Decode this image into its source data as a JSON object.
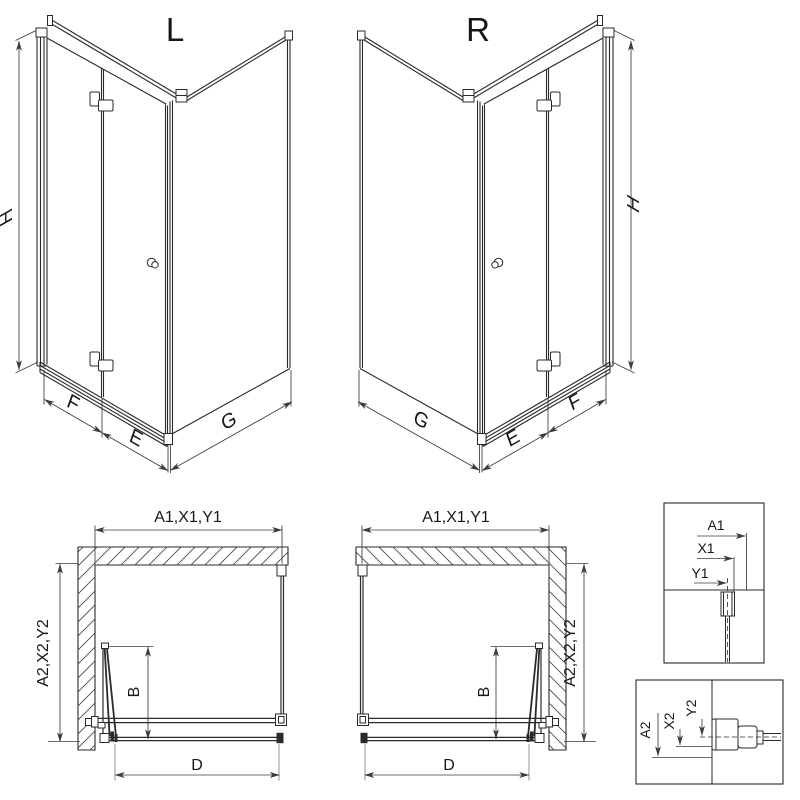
{
  "drawing": {
    "background": "#ffffff",
    "line_color": "#2a2a2a",
    "dim_color": "#3c3c3c",
    "views": {
      "iso_left": {
        "label": "L",
        "height_dim": "H",
        "door_fold_dim": "F",
        "door_fixed_dim": "E",
        "side_panel_dim": "G"
      },
      "iso_right": {
        "label": "R",
        "height_dim": "H",
        "door_fold_dim": "F",
        "door_fixed_dim": "E",
        "side_panel_dim": "G"
      },
      "plan_left": {
        "width_dim": "A1,X1,Y1",
        "depth_dim": "A2,X2,Y2",
        "door_dim": "B",
        "opening_dim": "D"
      },
      "plan_right": {
        "width_dim": "A1,X1,Y1",
        "depth_dim": "A2,X2,Y2",
        "door_dim": "B",
        "opening_dim": "D"
      },
      "detail_width": {
        "dim_a": "A1",
        "dim_x": "X1",
        "dim_y": "Y1"
      },
      "detail_depth": {
        "dim_a": "A2",
        "dim_x": "X2",
        "dim_y": "Y2"
      }
    }
  }
}
